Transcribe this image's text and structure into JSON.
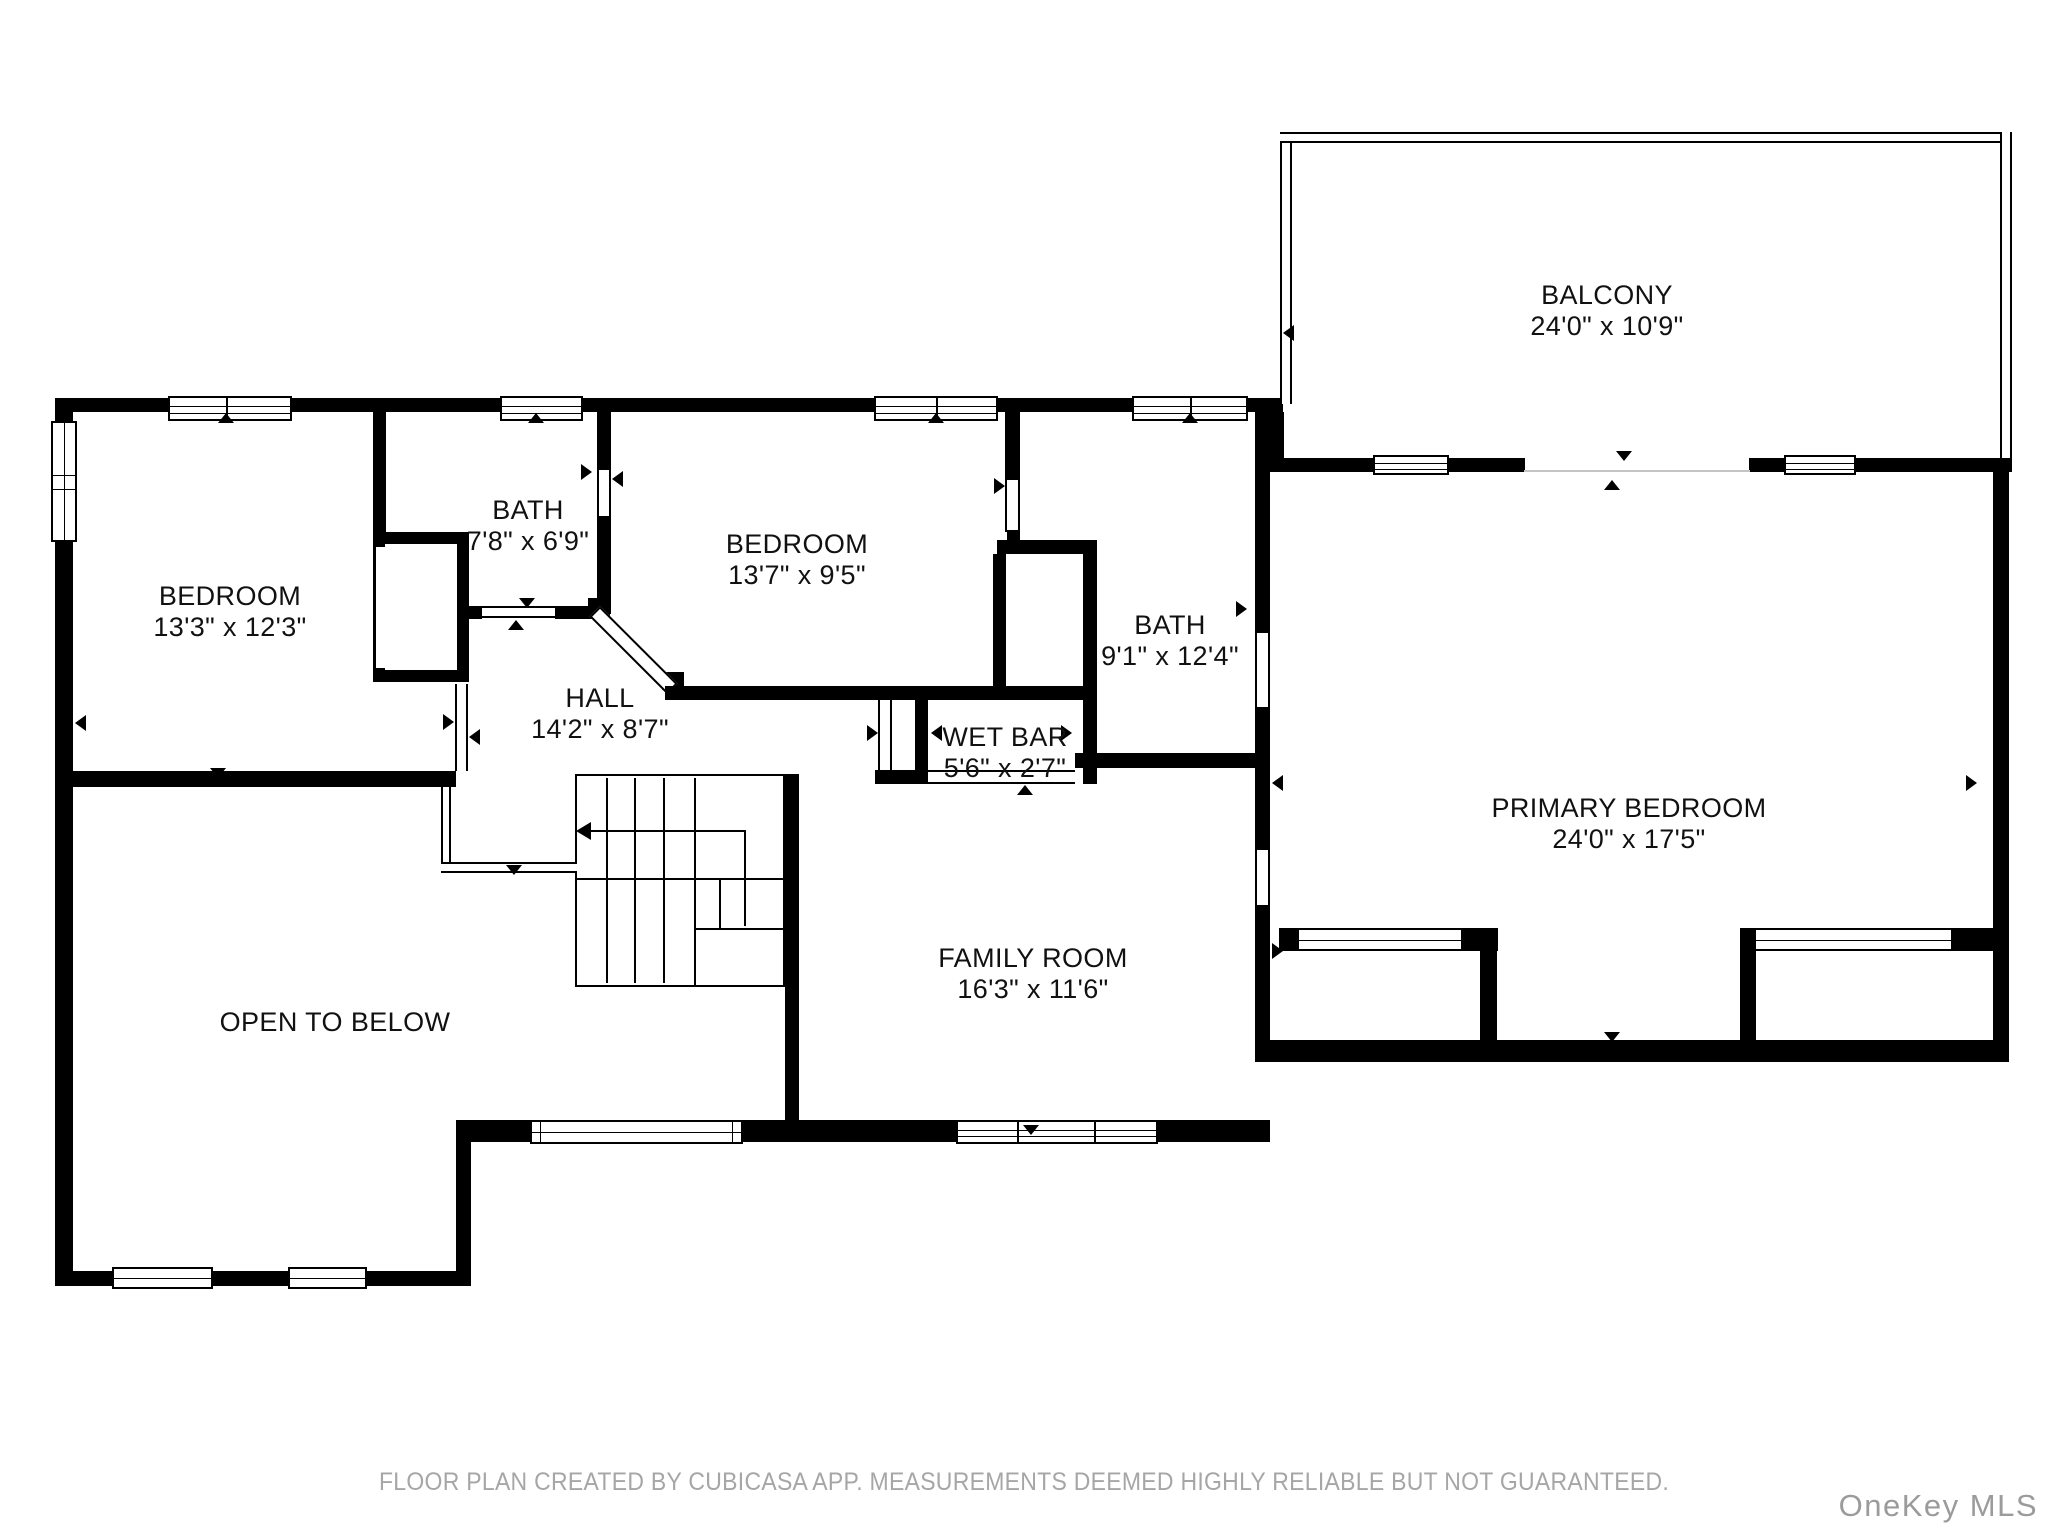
{
  "rooms": [
    {
      "name": "BEDROOM",
      "dims": "13'3\" x 12'3\""
    },
    {
      "name": "BATH",
      "dims": "7'8\" x 6'9\""
    },
    {
      "name": "BEDROOM",
      "dims": "13'7\" x 9'5\""
    },
    {
      "name": "BATH",
      "dims": "9'1\" x 12'4\""
    },
    {
      "name": "HALL",
      "dims": "14'2\" x 8'7\""
    },
    {
      "name": "WET BAR",
      "dims": "5'6\" x 2'7\""
    },
    {
      "name": "PRIMARY BEDROOM",
      "dims": "24'0\" x 17'5\""
    },
    {
      "name": "FAMILY ROOM",
      "dims": "16'3\" x 11'6\""
    },
    {
      "name": "BALCONY",
      "dims": "24'0\" x 10'9\""
    },
    {
      "name": "OPEN TO BELOW",
      "dims": ""
    }
  ],
  "footer": {
    "disclaimer": "FLOOR PLAN CREATED BY CUBICASA APP. MEASUREMENTS DEEMED HIGHLY RELIABLE BUT NOT GUARANTEED."
  },
  "watermark": {
    "text": "OneKey MLS"
  },
  "colors": {
    "wall": "#000000",
    "background": "#ffffff",
    "footer_text": "#a6a6a6",
    "watermark_text": "#9b9b9b"
  }
}
